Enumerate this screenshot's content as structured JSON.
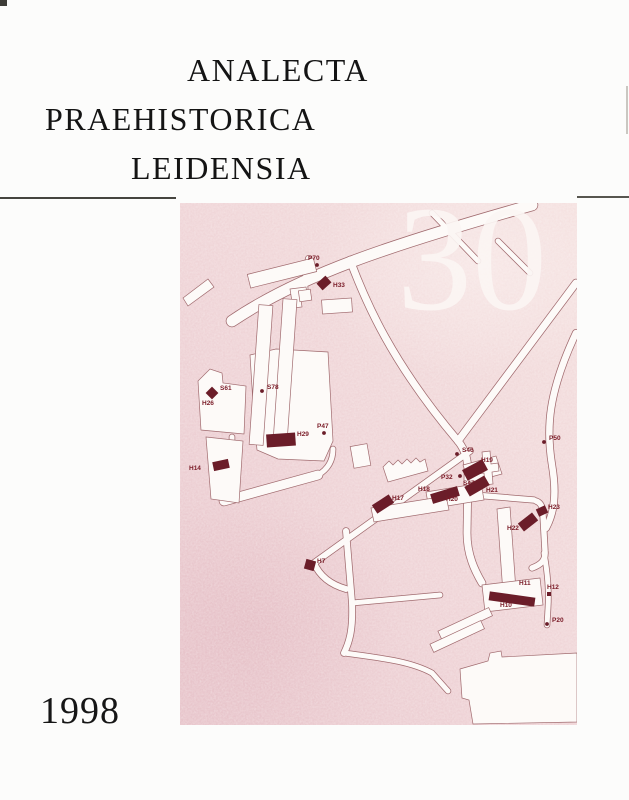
{
  "page": {
    "title_lines": [
      "ANALECTA",
      "PRAEHISTORICA",
      "LEIDENSIA"
    ],
    "year": "1998",
    "volume": "30"
  },
  "colors": {
    "map_pink": "#eed2d6",
    "map_pink_light": "#f6e5e4",
    "map_pink_dark": "#e7c4ca",
    "road_fill": "#fdfaf8",
    "road_outline": "#a06a6e",
    "marker": "#6b1d29",
    "label": "#7a1b27",
    "volume_white": "#fbf5f3",
    "rule": "#45443f"
  },
  "map": {
    "markers": [
      {
        "id": "P70",
        "type": "dot",
        "x": 137,
        "y": 62,
        "lx": 128,
        "ly": 57,
        "anchor": "start"
      },
      {
        "id": "H33",
        "type": "bar",
        "x": 144,
        "y": 80,
        "w": 12,
        "h": 9,
        "rot": -42,
        "lx": 153,
        "ly": 84,
        "anchor": "start"
      },
      {
        "id": "S61",
        "type": "diamond",
        "x": 32,
        "y": 190,
        "w": 9,
        "h": 9,
        "rot": 45,
        "lx": 40,
        "ly": 187,
        "anchor": "start"
      },
      {
        "id": "H26",
        "type": "label",
        "lx": 22,
        "ly": 202,
        "anchor": "start"
      },
      {
        "id": "S78",
        "type": "dot",
        "x": 82,
        "y": 188,
        "lx": 87,
        "ly": 186,
        "anchor": "start"
      },
      {
        "id": "H29",
        "type": "bar",
        "x": 101,
        "y": 237,
        "w": 29,
        "h": 13,
        "rot": -4,
        "lx": 117,
        "ly": 233,
        "anchor": "start"
      },
      {
        "id": "P47",
        "type": "dot",
        "x": 144,
        "y": 230,
        "lx": 137,
        "ly": 225,
        "anchor": "start"
      },
      {
        "id": "H14",
        "type": "bar",
        "x": 41,
        "y": 262,
        "w": 16,
        "h": 9,
        "rot": -12,
        "lx": 9,
        "ly": 267,
        "anchor": "start"
      },
      {
        "id": "S46",
        "type": "dot",
        "x": 277,
        "y": 251,
        "lx": 282,
        "ly": 249,
        "anchor": "start"
      },
      {
        "id": "P50",
        "type": "dot",
        "x": 364,
        "y": 239,
        "lx": 369,
        "ly": 237,
        "anchor": "start"
      },
      {
        "id": "H19",
        "type": "bar",
        "x": 295,
        "y": 267,
        "w": 23,
        "h": 12,
        "rot": -28,
        "lx": 301,
        "ly": 259,
        "anchor": "start"
      },
      {
        "id": "P32",
        "type": "dot",
        "x": 280,
        "y": 273,
        "lx": 261,
        "ly": 276,
        "anchor": "start"
      },
      {
        "id": "S47",
        "type": "label",
        "lx": 283,
        "ly": 282,
        "anchor": "start"
      },
      {
        "id": "H21",
        "type": "bar",
        "x": 297,
        "y": 283,
        "w": 23,
        "h": 11,
        "rot": -30,
        "lx": 306,
        "ly": 289,
        "anchor": "start"
      },
      {
        "id": "H18",
        "type": "bar",
        "x": 265,
        "y": 292,
        "w": 28,
        "h": 10,
        "rot": -17,
        "lx": 238,
        "ly": 288,
        "anchor": "start"
      },
      {
        "id": "H20",
        "type": "label",
        "lx": 266,
        "ly": 298,
        "anchor": "start"
      },
      {
        "id": "H17",
        "type": "bar",
        "x": 203,
        "y": 301,
        "w": 20,
        "h": 10,
        "rot": -33,
        "lx": 212,
        "ly": 297,
        "anchor": "start"
      },
      {
        "id": "H23",
        "type": "bar",
        "x": 362,
        "y": 308,
        "w": 10,
        "h": 8,
        "rot": -25,
        "lx": 368,
        "ly": 306,
        "anchor": "start"
      },
      {
        "id": "H22",
        "type": "bar",
        "x": 348,
        "y": 319,
        "w": 18,
        "h": 10,
        "rot": -38,
        "lx": 327,
        "ly": 327,
        "anchor": "start"
      },
      {
        "id": "H7",
        "type": "square",
        "x": 130,
        "y": 362,
        "w": 10,
        "h": 10,
        "rot": 15,
        "lx": 137,
        "ly": 360,
        "anchor": "start"
      },
      {
        "id": "H11",
        "type": "label",
        "lx": 339,
        "ly": 382,
        "anchor": "start"
      },
      {
        "id": "H10",
        "type": "bar",
        "x": 332,
        "y": 396,
        "w": 46,
        "h": 9,
        "rot": 8,
        "lx": 320,
        "ly": 404,
        "anchor": "start"
      },
      {
        "id": "H12",
        "type": "square",
        "x": 369,
        "y": 391,
        "w": 4,
        "h": 4,
        "rot": 0,
        "lx": 367,
        "ly": 386,
        "anchor": "start"
      },
      {
        "id": "P20",
        "type": "dot",
        "x": 367,
        "y": 421,
        "lx": 372,
        "ly": 419,
        "anchor": "start"
      }
    ]
  }
}
